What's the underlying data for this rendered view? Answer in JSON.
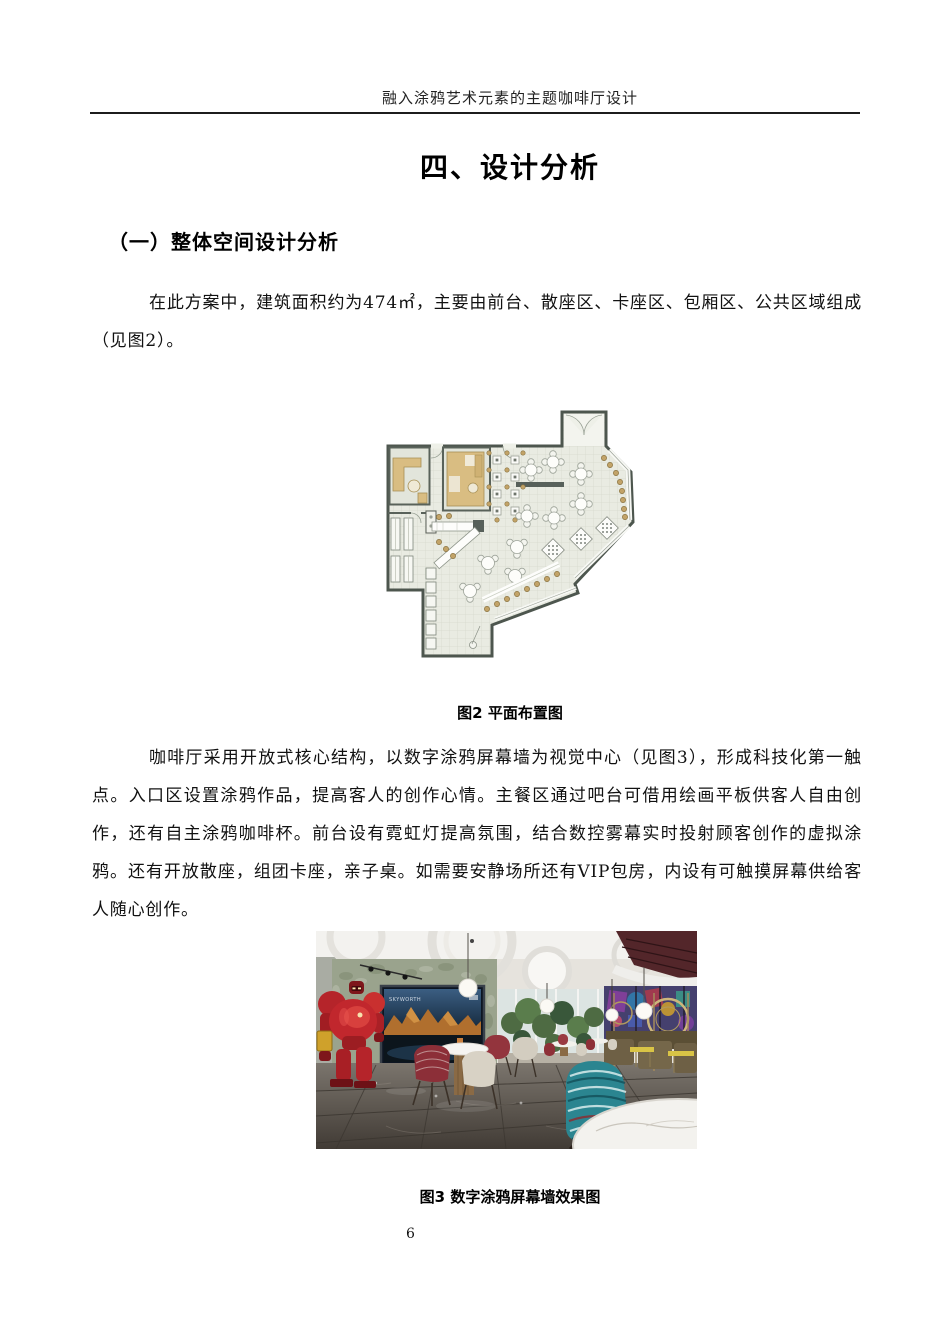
{
  "header": {
    "running_head": "融入涂鸦艺术元素的主题咖啡厅设计"
  },
  "title": "四、设计分析",
  "section_heading": "（一）整体空间设计分析",
  "paragraphs": [
    "在此方案中，建筑面积约为474㎡，主要由前台、散座区、卡座区、包厢区、公共区域组成（见图2）。",
    "咖啡厅采用开放式核心结构，以数字涂鸦屏幕墙为视觉中心（见图3），形成科技化第一触点。入口区设置涂鸦作品，提高客人的创作心情。主餐区通过吧台可借用绘画平板供客人自由创作，还有自主涂鸦咖啡杯。前台设有霓虹灯提高氛围，结合数控雾幕实时投射顾客创作的虚拟涂鸦。还有开放散座，组团卡座，亲子桌。如需要安静场所还有VIP包房，内设有可触摸屏幕供给客人随心创作。"
  ],
  "figures": [
    {
      "caption": "图2 平面布置图"
    },
    {
      "caption": "图3 数字涂鸦屏幕墙效果图",
      "screen_brand": "SKYWORTH"
    }
  ],
  "page_number": "6"
}
